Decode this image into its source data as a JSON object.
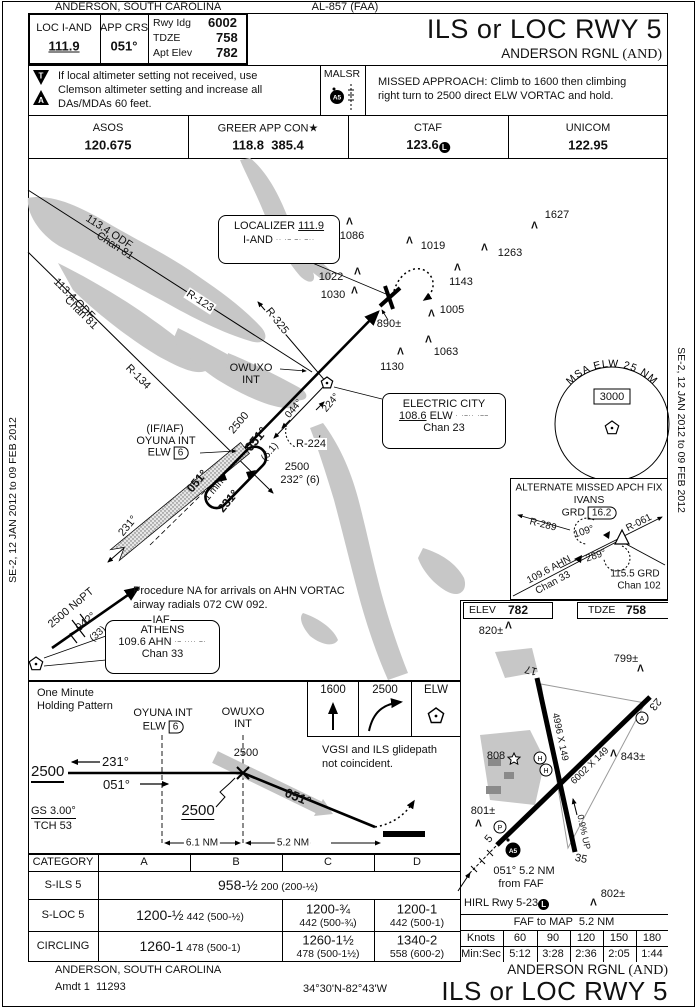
{
  "edition": {
    "left": "SE-2, 12 JAN 2012 to 09 FEB 2012",
    "right": "SE-2, 12 JAN 2012 to 09 FEB 2012"
  },
  "header": {
    "city": "ANDERSON, SOUTH CAROLINA",
    "al_number": "AL-857 (FAA)",
    "loc_label": "LOC I-AND",
    "loc_freq": "111.9",
    "app_crs_label": "APP CRS",
    "app_crs": "051°",
    "rwy_ldg_label": "Rwy Idg",
    "rwy_ldg": "6002",
    "tdze_label": "TDZE",
    "tdze": "758",
    "apt_elev_label": "Apt Elev",
    "apt_elev": "782",
    "title": "ILS or LOC RWY 5",
    "airport": "ANDERSON RGNL",
    "airport_id": "(AND)",
    "takeoff_tri": "T",
    "alternate_tri": "A",
    "note_lines": [
      "If local altimeter setting not received, use",
      "Clemson altimeter setting and increase all",
      "DAs/MDAs 60 feet."
    ],
    "malsr_label": "MALSR",
    "malsr_badge": "A5",
    "missed_lines": [
      "MISSED APPROACH: Climb to 1600 then climbing",
      "right turn to 2500 direct ELW VORTAC and hold."
    ]
  },
  "comms": {
    "asos_label": "ASOS",
    "asos": "120.675",
    "app_label": "GREER APP CON★",
    "app": "118.8  385.4",
    "ctaf_label": "CTAF",
    "ctaf": "123.6",
    "ctaf_badge": "L",
    "unicom_label": "UNICOM",
    "unicom": "122.95"
  },
  "plan": {
    "odf1_freq": "113.4 ODF",
    "odf1_chan": "Chan 81",
    "odf2_freq": "113.4 ODF",
    "odf2_chan": "Chan 81",
    "r123": "R-123",
    "r134": "R-134",
    "r325": "R-325",
    "r224": "R-224",
    "loc_name": "LOCALIZER",
    "loc_freq": "111.9",
    "loc_ident": "I-AND",
    "loc_morse": "·· ·– –· –··",
    "obstacles": [
      "1086",
      "1019",
      "1263",
      "1627",
      "1143",
      "1005",
      "1063",
      "1130",
      "1022",
      "1030",
      "890±"
    ],
    "owuxo": "OWUXO",
    "owuxo_int": "INT",
    "ec_name": "ELECTRIC CITY",
    "ec_freq": "108.6",
    "ec_ident": "ELW",
    "ec_morse": "· ·–·· ·––",
    "ec_chan": "Chan 23",
    "c044": "044°",
    "c224": "224°",
    "course_alt": "2500",
    "course": "051°",
    "course_dist": "(6.1)",
    "if_label": "(IF/IAF)",
    "if_name": "OYUNA INT",
    "if_nav": "ELW",
    "if_dme": "6",
    "hold_in": "051°",
    "hold_time": "1 min",
    "hold_out": "231°",
    "feather_crs": "231°",
    "stepdown_alt": "2500",
    "stepdown": "232° (6)",
    "msa_label": "MSA ELW 25 NM",
    "msa_alt": "3000",
    "nopt": "2500 NoPT",
    "nopt_crs": "042°",
    "nopt_dist": "(33)",
    "athens_iaf": "IAF",
    "athens_name": "ATHENS",
    "athens_freq": "109.6",
    "athens_ident": "AHN",
    "athens_morse": "·– ···· –·",
    "athens_chan": "Chan 33",
    "note_lines": [
      "Procedure NA for arrivals on AHN VORTAC",
      "airway radials 072 CW 092."
    ],
    "amaf_title": "ALTERNATE MISSED APCH FIX",
    "amaf_fix": "IVANS",
    "amaf_nav": "GRD",
    "amaf_dme": "16.2",
    "amaf_r289": "R-289",
    "amaf_c109": "109°",
    "amaf_r061": "R-061",
    "amaf_c289": "289°",
    "amaf_ahn": "109.6 AHN",
    "amaf_ahn_chan": "Chan 33",
    "amaf_grd": "115.5 GRD",
    "amaf_grd_chan": "Chan 102"
  },
  "profile": {
    "hold_l1": "One Minute",
    "hold_l2": "Holding Pattern",
    "oyuna": "OYUNA INT",
    "oyuna_nav": "ELW",
    "oyuna_dme": "6",
    "owuxo": "OWUXO",
    "owuxo_int": "INT",
    "level_alt": "2500",
    "out_crs": "231°",
    "in_crs": "051°",
    "faf_alt": "2500",
    "faf_alt2": "2500",
    "descent_crs": "051°",
    "gs": "GS 3.00°",
    "tch": "TCH 53",
    "d1": "6.1 NM",
    "d2": "5.2 NM",
    "ma1": "1600",
    "ma2": "2500",
    "ma3": "ELW",
    "vgsi_lines": [
      "VGSI and ILS glidepath",
      "not coincident."
    ]
  },
  "minimums": {
    "headers": [
      "CATEGORY",
      "A",
      "B",
      "C",
      "D"
    ],
    "sils_label": "S-ILS 5",
    "sils_main": "958-½",
    "sils_paren": "200 (200-½)",
    "sloc_label": "S-LOC 5",
    "sloc_ab_main": "1200-½",
    "sloc_ab_paren": "442 (500-½)",
    "sloc_c_main": "1200-¾",
    "sloc_c_paren": "442 (500-¾)",
    "sloc_d_main": "1200-1",
    "sloc_d_paren": "442 (500-1)",
    "circ_label": "CIRCLING",
    "circ_ab_main": "1260-1",
    "circ_ab_paren": "478 (500-1)",
    "circ_c_main": "1260-1½",
    "circ_c_paren": "478 (500-1½)",
    "circ_d_main": "1340-2",
    "circ_d_paren": "558 (600-2)"
  },
  "sketch": {
    "elev_label": "ELEV",
    "elev": "782",
    "tdze_label": "TDZE",
    "tdze": "758",
    "obstacles": [
      "820±",
      "799±",
      "843±",
      "808",
      "801±",
      "802±"
    ],
    "rwy17": "17",
    "rwy35": "35",
    "rwy5": "5",
    "rwy23": "23",
    "rwy1735_dim": "4996 X 149",
    "rwy523_dim": "6002 X 149",
    "gradient": "0.9% UP",
    "faf_l1": "051° 5.2 NM",
    "faf_l2": "from FAF",
    "hirl": "HIRL Rwy 5-23",
    "hirl_badge": "L",
    "malsr_badge": "A5",
    "papi": "P",
    "beacon": "A",
    "helipad": "H"
  },
  "timetable": {
    "faf_map": "FAF to MAP  5.2 NM",
    "knots_label": "Knots",
    "knots": [
      "60",
      "90",
      "120",
      "150",
      "180"
    ],
    "minsec_label": "Min:Sec",
    "minsec": [
      "5:12",
      "3:28",
      "2:36",
      "2:05",
      "1:44"
    ]
  },
  "footer": {
    "city": "ANDERSON, SOUTH CAROLINA",
    "amdt": "Amdt 1  11293",
    "coords": "34°30'N-82°43'W",
    "airport": "ANDERSON RGNL",
    "airport_id": "(AND)",
    "title": "ILS or LOC RWY 5"
  }
}
